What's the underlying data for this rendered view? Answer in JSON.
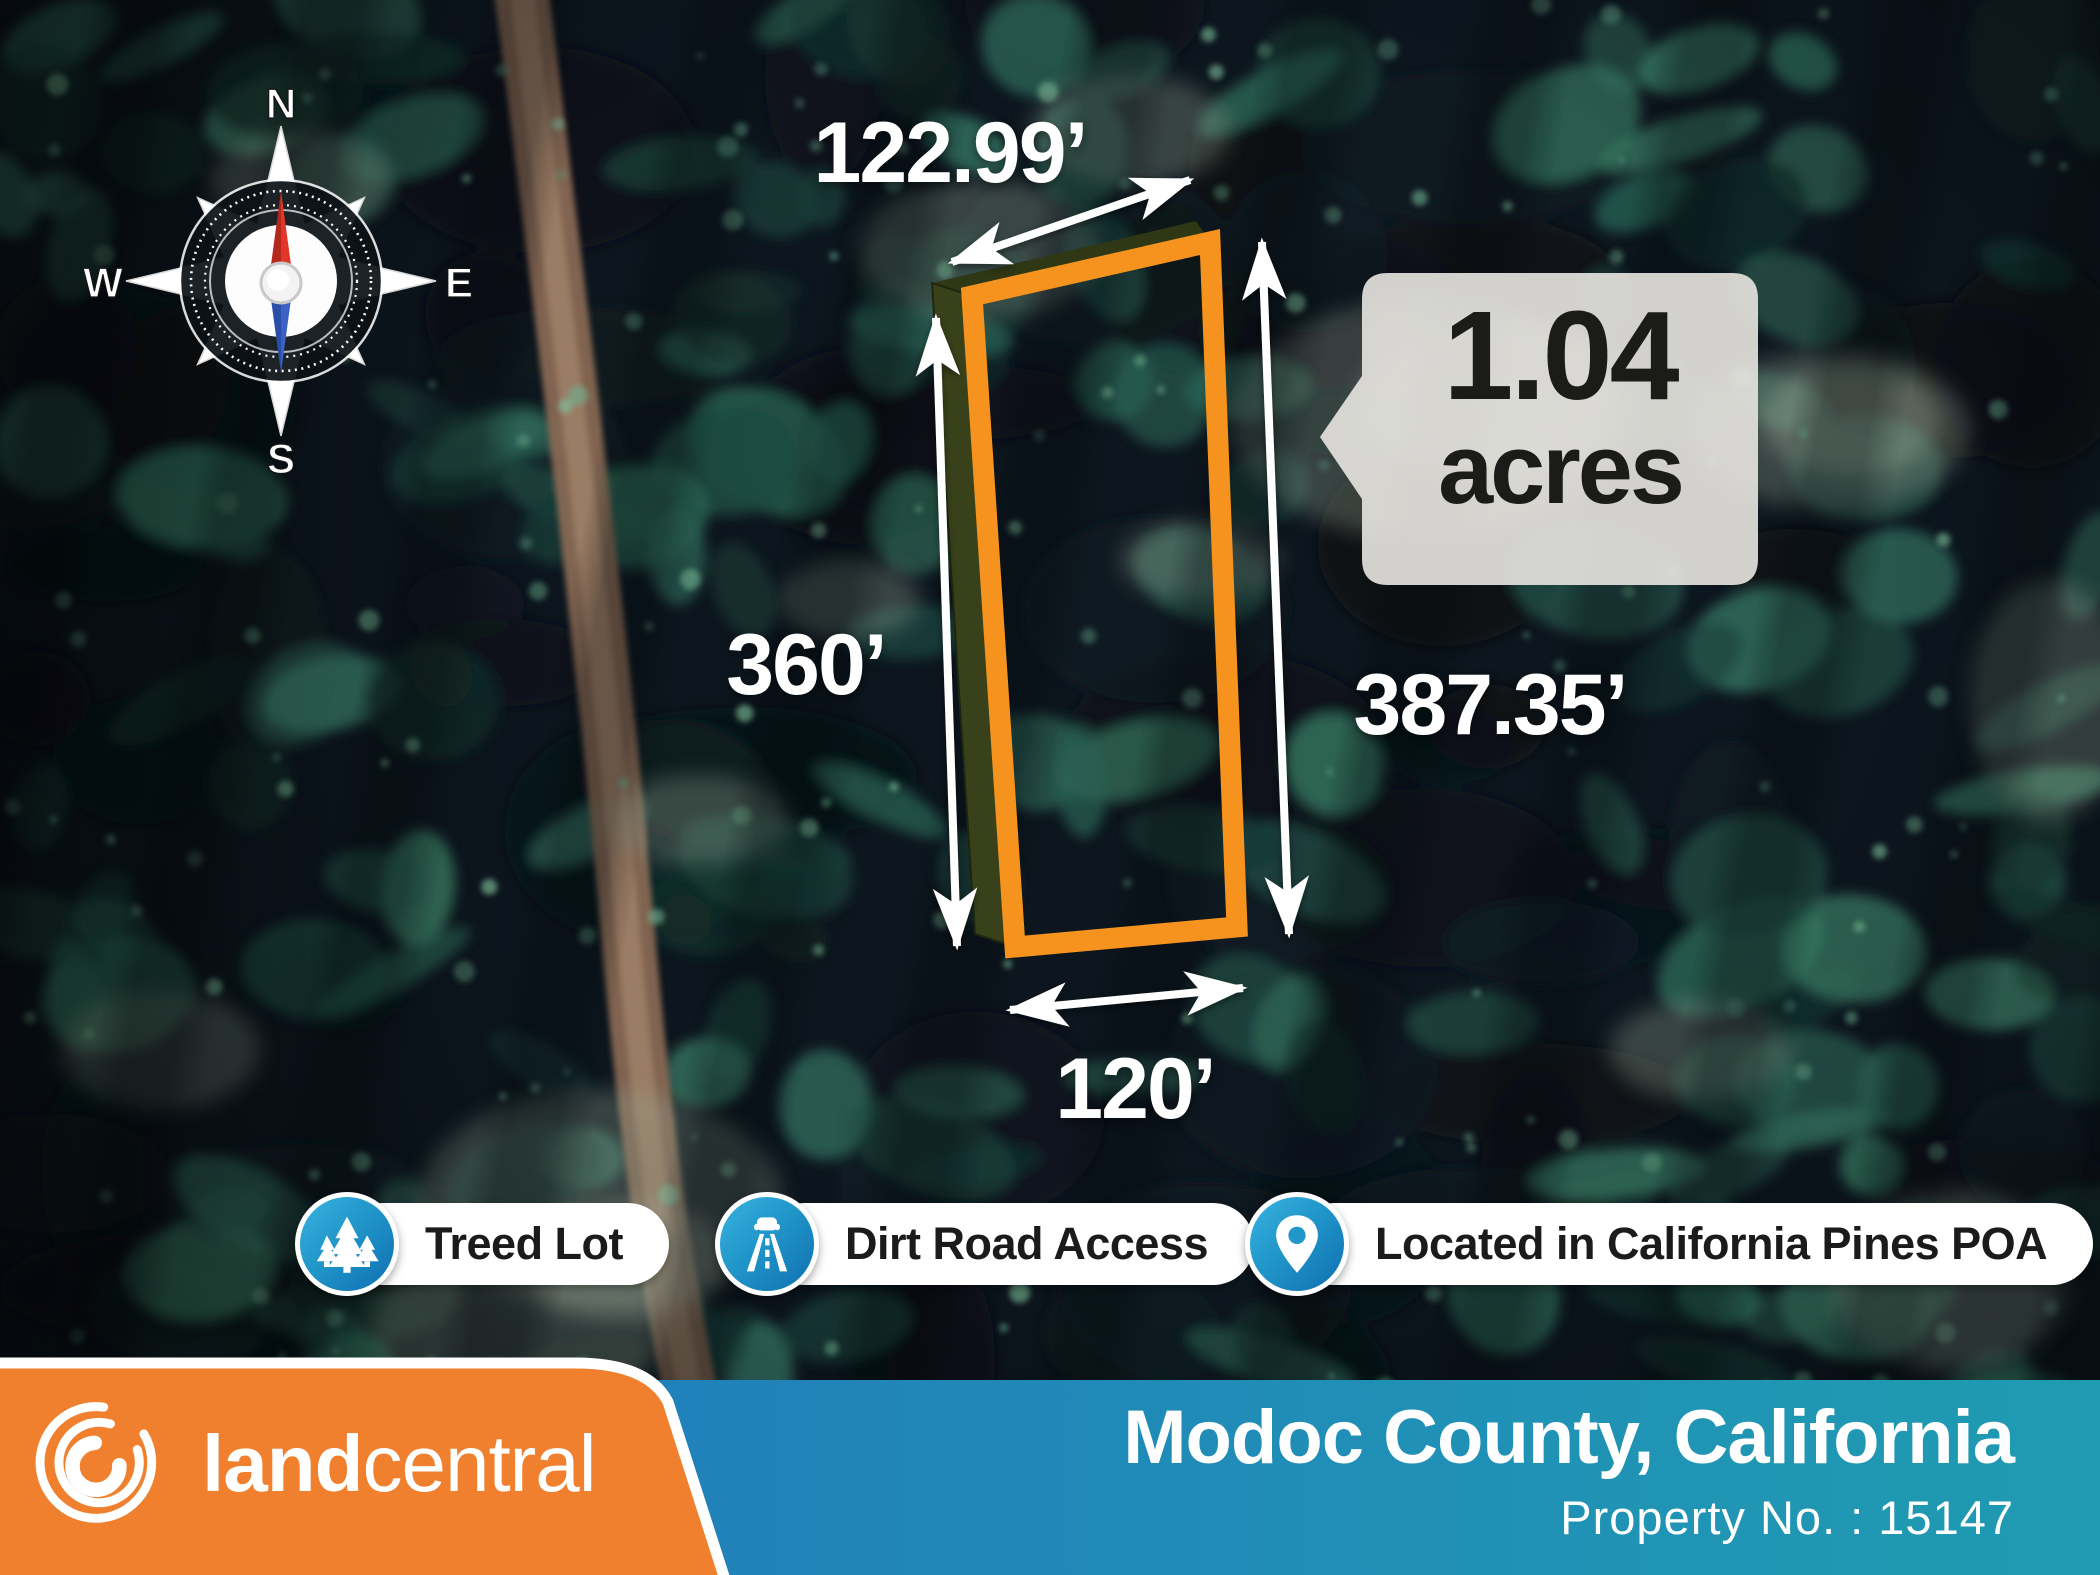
{
  "compass": {
    "n": "N",
    "e": "E",
    "s": "S",
    "w": "W"
  },
  "property": {
    "area": {
      "value": "1.04",
      "unit": "acres"
    },
    "dimensions": {
      "top": "122.99’",
      "left": "360’",
      "right": "387.35’",
      "bottom": "120’"
    },
    "county": "Modoc County, California",
    "property_no": "Property No. : 15147"
  },
  "features": [
    {
      "icon": "pine-trees-icon",
      "label": "Treed Lot"
    },
    {
      "icon": "dirt-road-icon",
      "label": "Dirt Road Access"
    },
    {
      "icon": "location-pin-icon",
      "label": "Located in California Pines POA"
    }
  ],
  "brand": {
    "bold": "land",
    "light": "central"
  },
  "colors": {
    "accent_orange": "#F0802E",
    "parcel_orange": "#F6931E",
    "bar_blue_left": "#2272BC",
    "bar_blue_right": "#1F9BB1",
    "badge_blue": "#2196C9",
    "callout_bg": "#E4E2DD"
  }
}
